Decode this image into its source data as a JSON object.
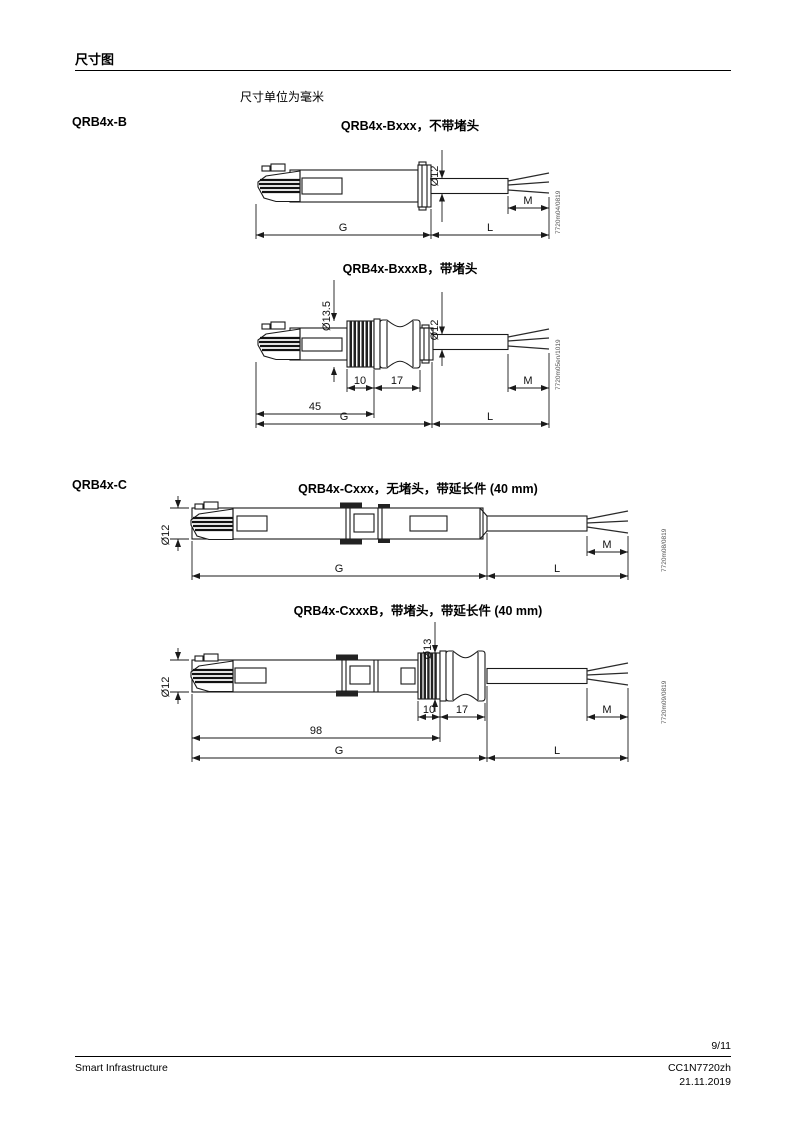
{
  "page": {
    "heading": "尺寸图",
    "unit_note": "尺寸单位为毫米"
  },
  "sections": {
    "b_label": "QRB4x-B",
    "c_label": "QRB4x-C"
  },
  "drawings": [
    {
      "title": "QRB4x-Bxxx，不带堵头",
      "ref": "7720m04/0819",
      "dims": {
        "dia_cable": "Ø12",
        "g": "G",
        "l": "L",
        "m": "M"
      }
    },
    {
      "title": "QRB4x-BxxxB，带堵头",
      "ref": "7720m05en/1019",
      "dims": {
        "dia_plug": "Ø13.5",
        "dia_cable": "Ø12",
        "thread": "10",
        "grommet": "17",
        "head_to_plug": "45",
        "g": "G",
        "l": "L",
        "m": "M"
      }
    },
    {
      "title": "QRB4x-Cxxx，无堵头，带延长件 (40 mm)",
      "ref": "7720m08/0819",
      "dims": {
        "dia_body": "Ø12",
        "g": "G",
        "l": "L",
        "m": "M"
      }
    },
    {
      "title": "QRB4x-CxxxB，带堵头，带延长件 (40 mm)",
      "ref": "7720m09/0819",
      "dims": {
        "dia_body": "Ø12",
        "dia_plug": "Ø13",
        "thread": "10",
        "grommet": "17",
        "head_to_plug": "98",
        "g": "G",
        "l": "L",
        "m": "M"
      }
    }
  ],
  "footer": {
    "page_number": "9/11",
    "company": "Smart Infrastructure",
    "doc_id": "CC1N7720zh",
    "date": "21.11.2019"
  }
}
